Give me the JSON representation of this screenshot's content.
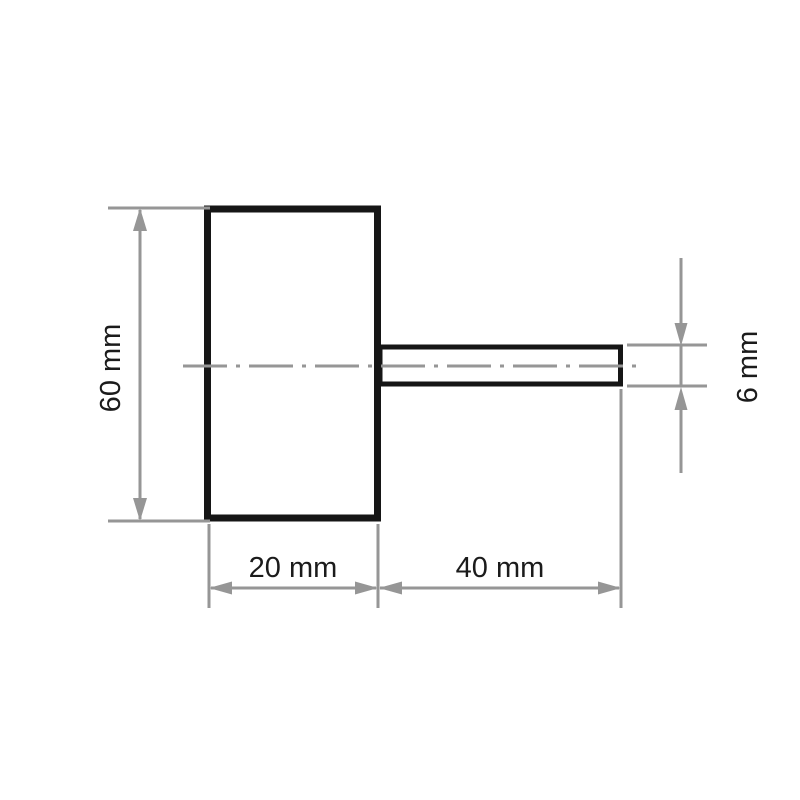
{
  "diagram": {
    "type": "technical-dimension-drawing",
    "labels": {
      "wheel_height": "60 mm",
      "wheel_width": "20 mm",
      "shank_length": "40 mm",
      "shank_diameter": "6 mm"
    },
    "colors": {
      "part_outline": "#161616",
      "dimension_lines": "#969696",
      "label_text": "#1b1b1b",
      "background": "#ffffff"
    }
  }
}
